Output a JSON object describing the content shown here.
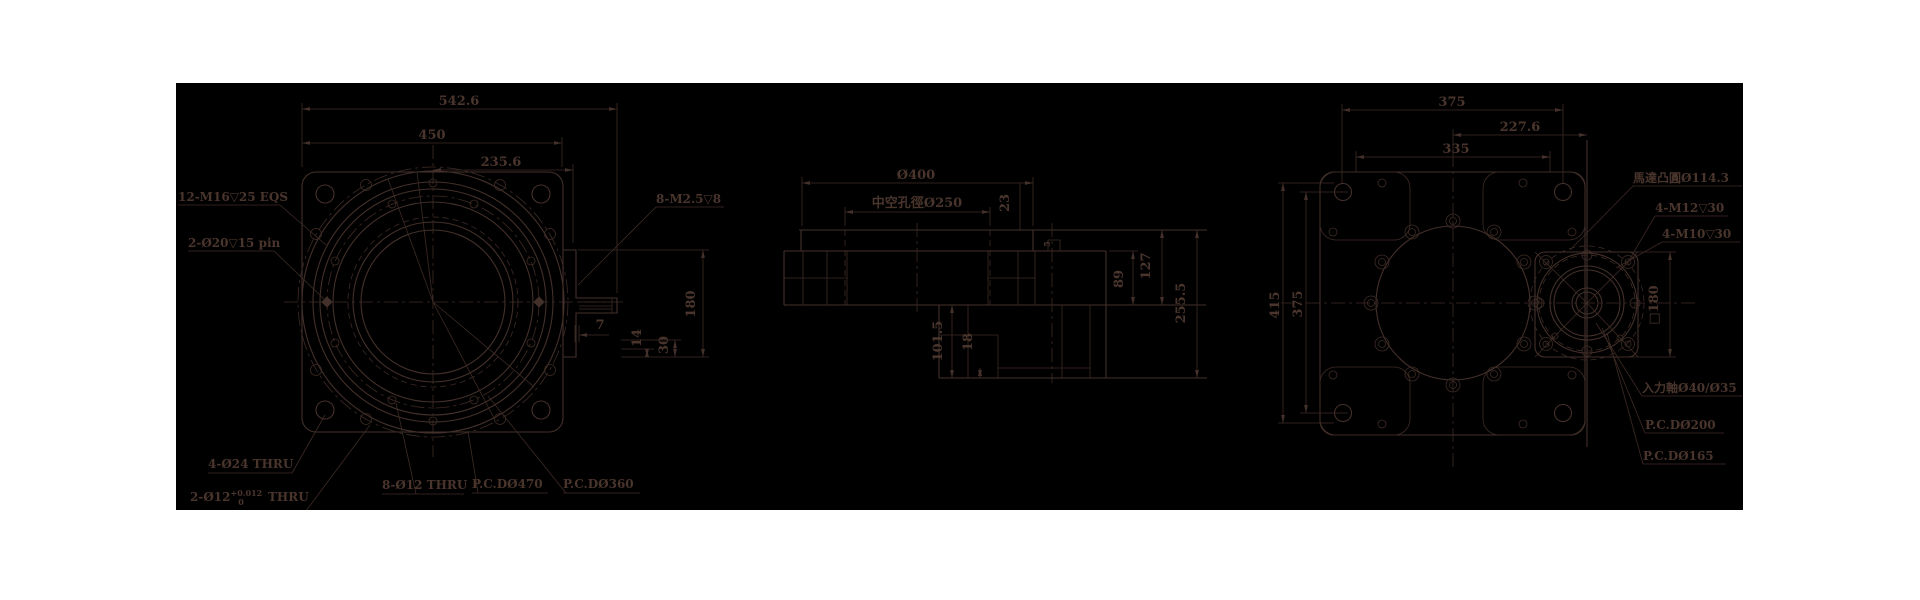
{
  "colors": {
    "page_background": "#ffffff",
    "canvas_background": "#000000",
    "line_color": "#43302a"
  },
  "front_view": {
    "dim_542": "542.6",
    "dim_450": "450",
    "dim_235": "235.6",
    "dim_180": "180",
    "dim_30": "30",
    "dim_14": "14",
    "dim_7": "7",
    "label_m16": "12-M16▽25 EQS",
    "label_pin": "2-Ø20▽15 pin",
    "label_m25": "8-M2.5▽8",
    "label_o24": "4-Ø24 THRU",
    "label_o12_base": "2-Ø12",
    "label_o12_sup": "+0.012",
    "label_o12_sub": "0",
    "label_o12_suffix": " THRU",
    "label_8o12": "8-Ø12 THRU",
    "label_pcd470": "P.C.DØ470",
    "label_pcd360": "P.C.DØ360"
  },
  "section_view": {
    "dim_400": "Ø400",
    "dim_bore": "中空孔徑Ø250",
    "dim_23": "23",
    "dim_5": "5",
    "dim_89": "89",
    "dim_127": "127",
    "dim_2555": "255.5",
    "dim_1015": "101.5",
    "dim_18": "18"
  },
  "rear_view": {
    "dim_375_top": "375",
    "dim_2276": "227.6",
    "dim_335": "335",
    "dim_415": "415",
    "dim_375_left": "375",
    "dim_sq180": "□180",
    "label_motor_boss": "馬達凸圓Ø114.3",
    "label_m12": "4-M12▽30",
    "label_m10": "4-M10▽30",
    "label_input_shaft": "入力軸Ø40/Ø35",
    "label_pcd200": "P.C.DØ200",
    "label_pcd165": "P.C.DØ165"
  }
}
